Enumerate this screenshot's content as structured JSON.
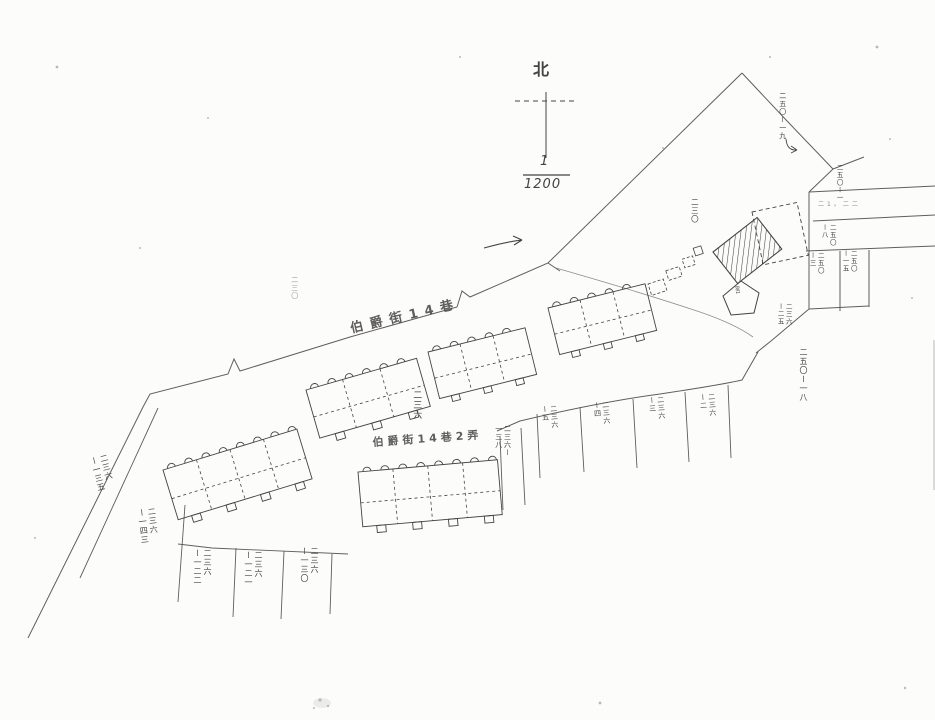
{
  "page": {
    "bg": "#fcfcfa",
    "ink": "#45433f"
  },
  "compass": {
    "label": "北"
  },
  "scale": {
    "numerator": "1",
    "denominator": "1200"
  },
  "streets": {
    "lane14": "伯爵街14巷",
    "alley2": "伯爵街14巷2弄"
  },
  "subject_marker": {
    "label": "電1"
  },
  "parcel_labels": [
    {
      "text": "二三〇",
      "x": 290,
      "y": 276,
      "size": 7,
      "opacity": 0.5
    },
    {
      "text": "二三〇",
      "x": 690,
      "y": 198,
      "size": 7.5
    },
    {
      "text": "二五〇ー一九",
      "x": 778,
      "y": 92,
      "size": 7
    },
    {
      "text": "二五〇ー一",
      "x": 835,
      "y": 164,
      "size": 6.5
    },
    {
      "text": "二1。二二",
      "x": 818,
      "y": 199,
      "size": 6,
      "h": true,
      "opacity": 0.6,
      "ls": 3
    },
    {
      "text": "二五〇\nー八",
      "x": 820,
      "y": 224,
      "size": 6.5
    },
    {
      "text": "二五〇\nー三",
      "x": 808,
      "y": 252,
      "size": 6.5
    },
    {
      "text": "二五〇\nー一五",
      "x": 841,
      "y": 250,
      "size": 6.5
    },
    {
      "text": "二三六\nー二五",
      "x": 776,
      "y": 303,
      "size": 6.5
    },
    {
      "text": "二五〇ー一八",
      "x": 798,
      "y": 348,
      "size": 8
    },
    {
      "text": "二三六\nー五",
      "x": 540,
      "y": 406,
      "size": 7,
      "rot": -4
    },
    {
      "text": "二三六\nー四",
      "x": 592,
      "y": 402,
      "size": 7,
      "rot": -4
    },
    {
      "text": "二三六\nー三",
      "x": 647,
      "y": 397,
      "size": 7,
      "rot": -4
    },
    {
      "text": "二三六\nー二",
      "x": 698,
      "y": 394,
      "size": 7,
      "rot": -4
    },
    {
      "text": "二三六ー\n一三八",
      "x": 494,
      "y": 425,
      "size": 7
    },
    {
      "text": "二三六",
      "x": 410,
      "y": 390,
      "size": 9
    },
    {
      "text": "二三六\nー一三五",
      "x": 88,
      "y": 458,
      "size": 8,
      "rot": -14
    },
    {
      "text": "二三六\nー一四三",
      "x": 136,
      "y": 509,
      "size": 8,
      "rot": -6
    },
    {
      "text": "二三六\nー一二二",
      "x": 192,
      "y": 549,
      "size": 8
    },
    {
      "text": "二三六\nー一二一",
      "x": 243,
      "y": 551,
      "size": 8
    },
    {
      "text": "二三六\nー一三〇",
      "x": 299,
      "y": 547,
      "size": 8
    }
  ]
}
